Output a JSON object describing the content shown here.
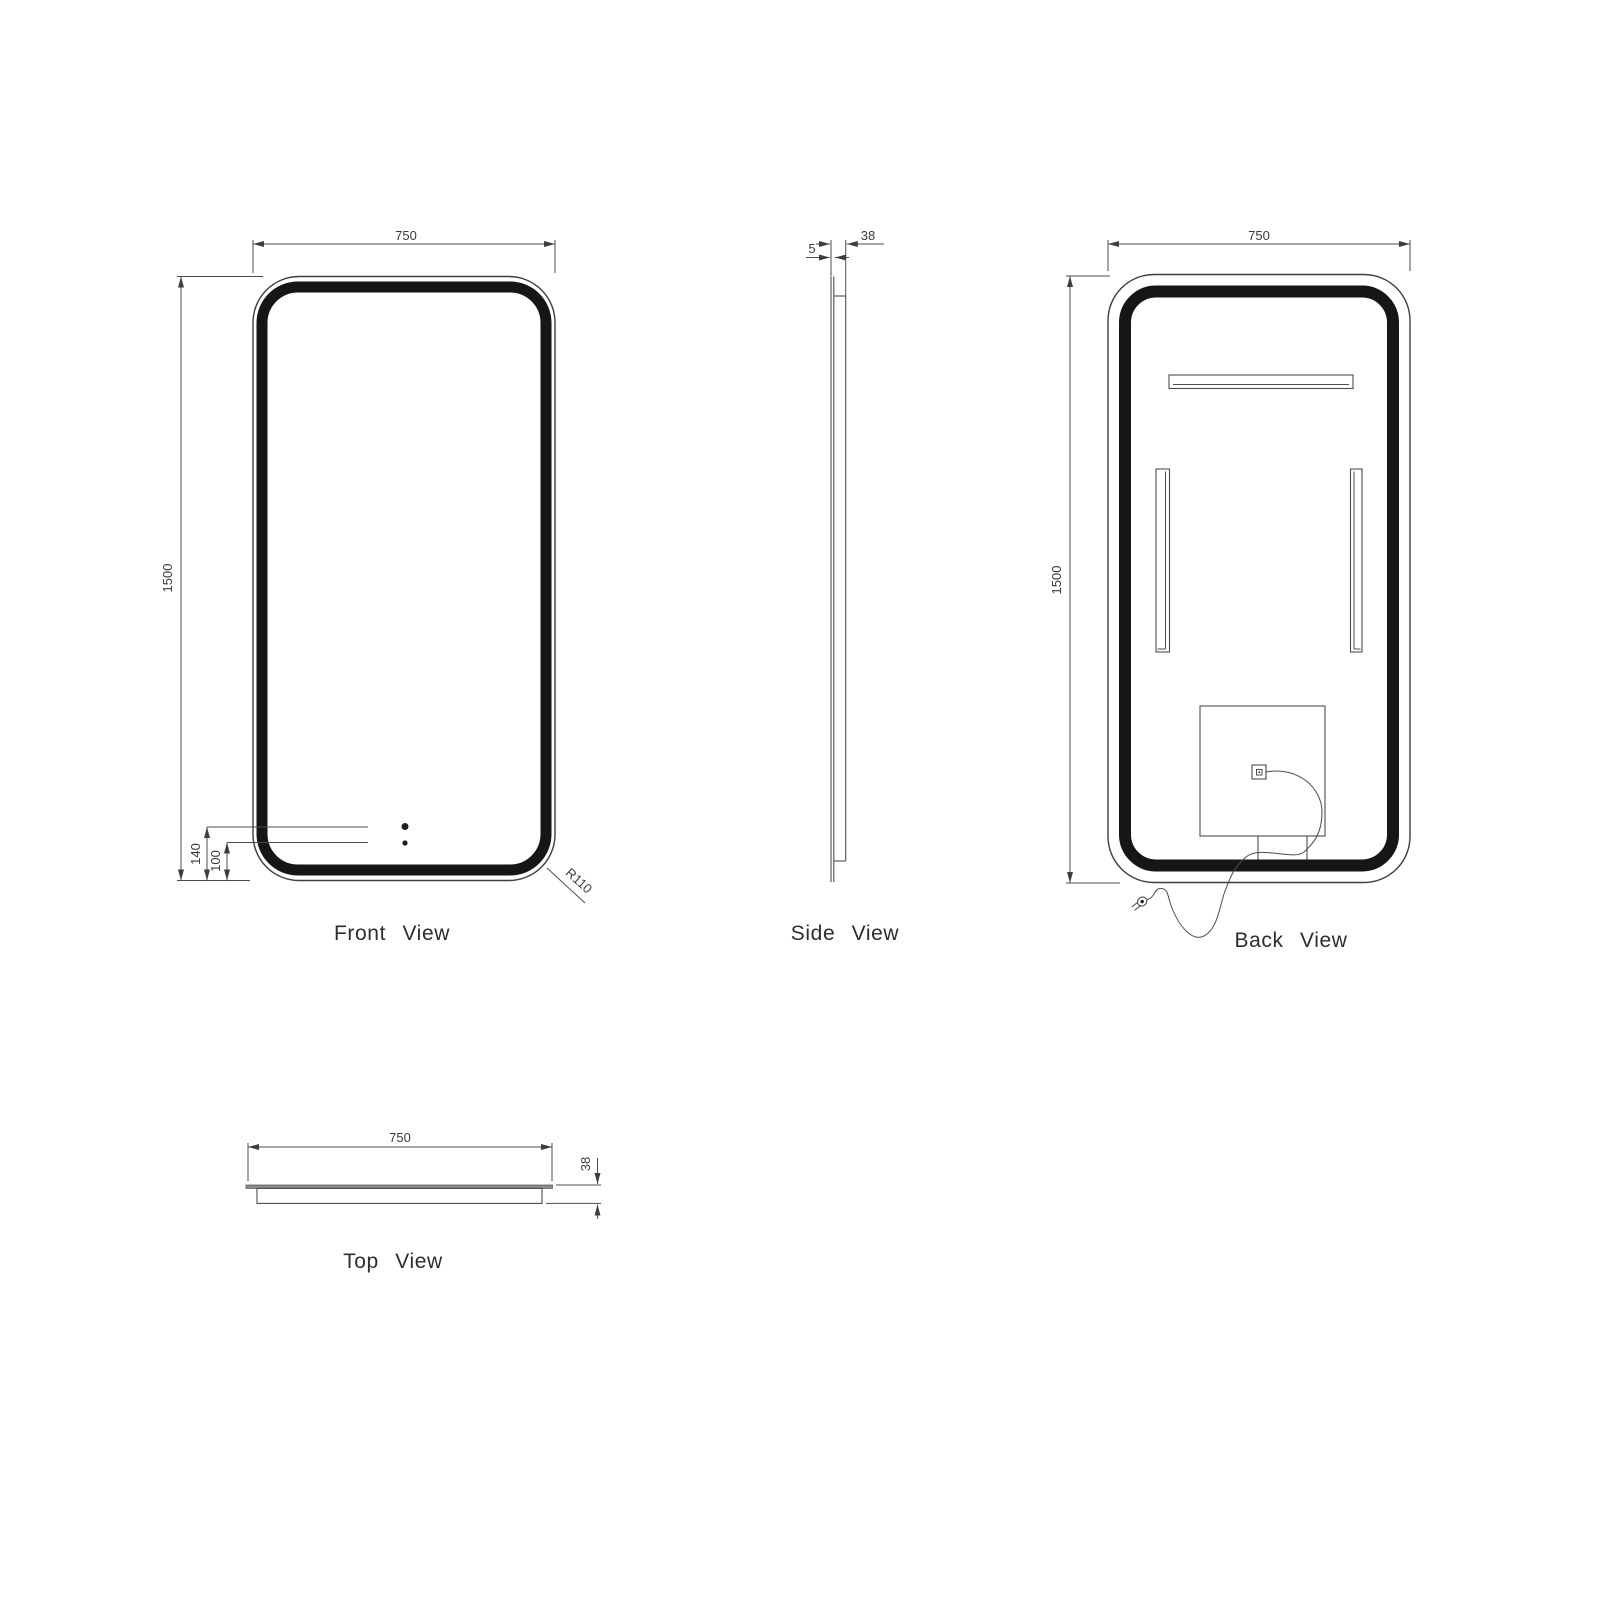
{
  "title": "LED Mirror Technical Drawing",
  "views": {
    "front": {
      "label": "Front View",
      "width": "750",
      "height": "1500",
      "sensor_upper_offset": "140",
      "sensor_lower_offset": "100",
      "corner_radius": "R110"
    },
    "side": {
      "label": "Side View",
      "glass_thickness": "5",
      "depth": "38"
    },
    "back": {
      "label": "Back View",
      "width": "750",
      "height": "1500"
    },
    "top": {
      "label": "Top View",
      "width": "750",
      "depth": "38"
    }
  },
  "colors": {
    "background": "#ffffff",
    "line": "#4d4d4d",
    "frame": "#161616",
    "text": "#333333"
  }
}
